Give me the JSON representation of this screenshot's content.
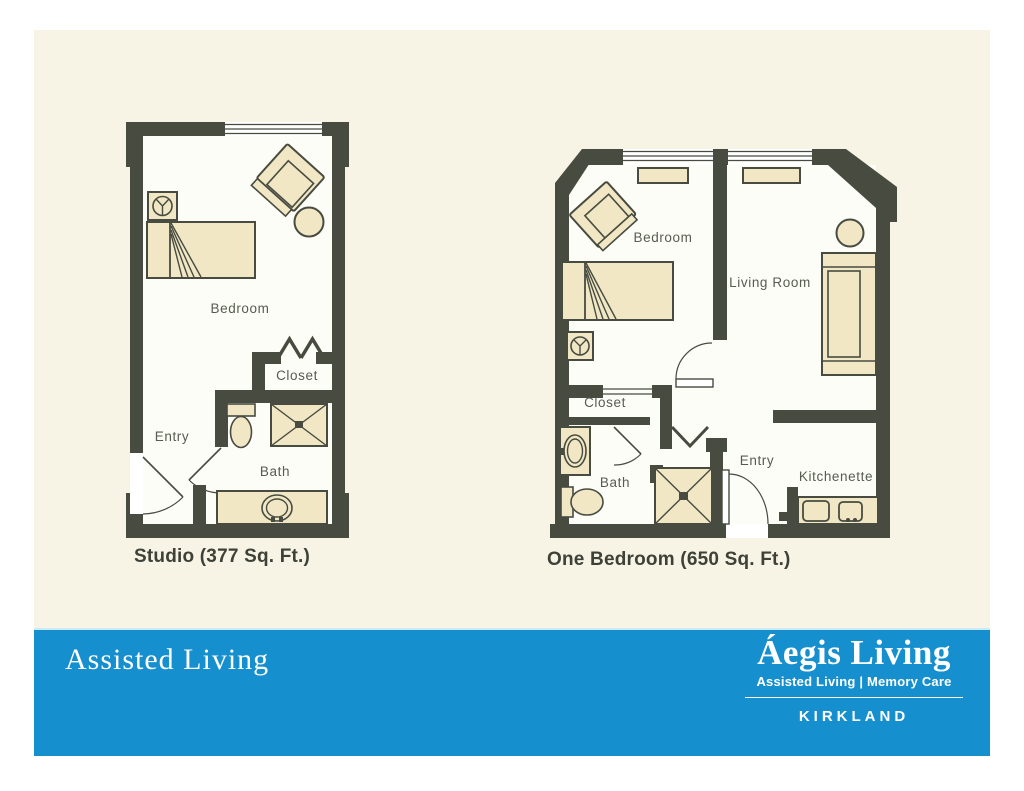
{
  "colors": {
    "page_cream": "#f8f4e5",
    "accent_blue": "#168fce",
    "wall": "#474b40",
    "room_fill": "#fdfdf8",
    "furniture_fill": "#f1e7c5",
    "caption_text": "#3d4137",
    "label_text": "#575c51"
  },
  "plans": [
    {
      "name": "studio",
      "caption": "Studio (377 Sq. Ft.)",
      "labels": {
        "bedroom": "Bedroom",
        "closet": "Closet",
        "entry": "Entry",
        "bath": "Bath"
      }
    },
    {
      "name": "one-bedroom",
      "caption": "One Bedroom (650 Sq. Ft.)",
      "labels": {
        "bedroom": "Bedroom",
        "living_room": "Living Room",
        "closet": "Closet",
        "bath": "Bath",
        "entry": "Entry",
        "kitchenette": "Kitchenette"
      }
    }
  ],
  "footer": {
    "heading": "Assisted Living",
    "logo_title": "Áegis Living",
    "logo_tagline": "Assisted Living | Memory Care",
    "location": "KIRKLAND"
  }
}
